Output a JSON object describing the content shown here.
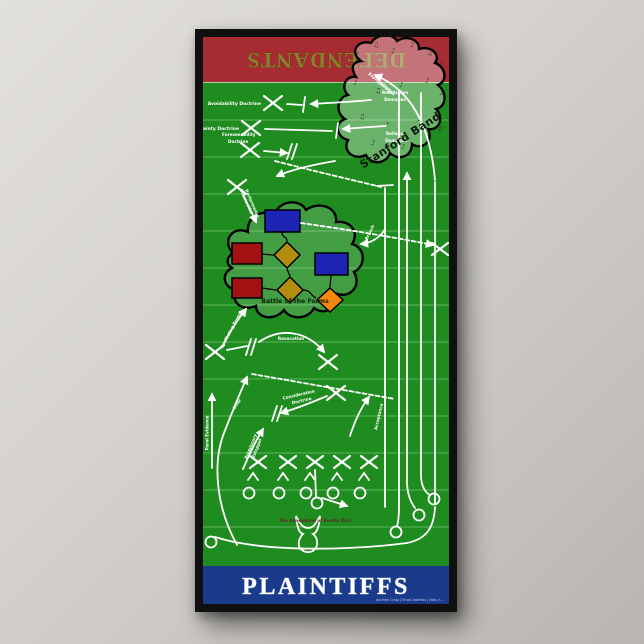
{
  "header": {
    "title": "DEFENDANTS"
  },
  "footer": {
    "title": "PLAINTIFFS",
    "fine_print": "Andrew Craig | Email Address | http://..."
  },
  "blobs": {
    "stanford": "Stanford Band",
    "battle": "Battle of the Forms"
  },
  "labels": {
    "avoidability": "Avoidability Doctrine",
    "certainty": "Certainty Doctrine",
    "foreseeability1": "Foreseeability",
    "foreseeability2": "Doctrine",
    "restitution1": "Restitution",
    "restitution2": "Damages",
    "reliance1": "Reliance",
    "reliance2": "Damages",
    "expectation1": "Expectation",
    "expectation2": "Damages",
    "substantial1": "Substantial",
    "substantial2": "Performance",
    "breach": "Breach",
    "conflicting": "Conflicting Terms",
    "revocation": "Revocation",
    "offer": "Offer",
    "consideration1": "Consideration",
    "consideration2": "Doctrine",
    "promissory1": "Promissory",
    "promissory2": "Estoppel",
    "parol": "Parol Evidence",
    "acceptance": "Acceptance",
    "annexation": "The Annexation of Puerto Rico"
  },
  "icons": {
    "music_note": "♪",
    "music_notes": "♫"
  },
  "colors": {
    "endzone_red": "#a62b33",
    "field_green": "#1f8c1f",
    "banner_blue": "#1a3a8c",
    "defendants_gold": "#8f7f2a",
    "flow_blue": "#1d23b2",
    "flow_red": "#a31212",
    "flow_olive": "#b08d0d",
    "flow_orange": "#f5870f"
  }
}
